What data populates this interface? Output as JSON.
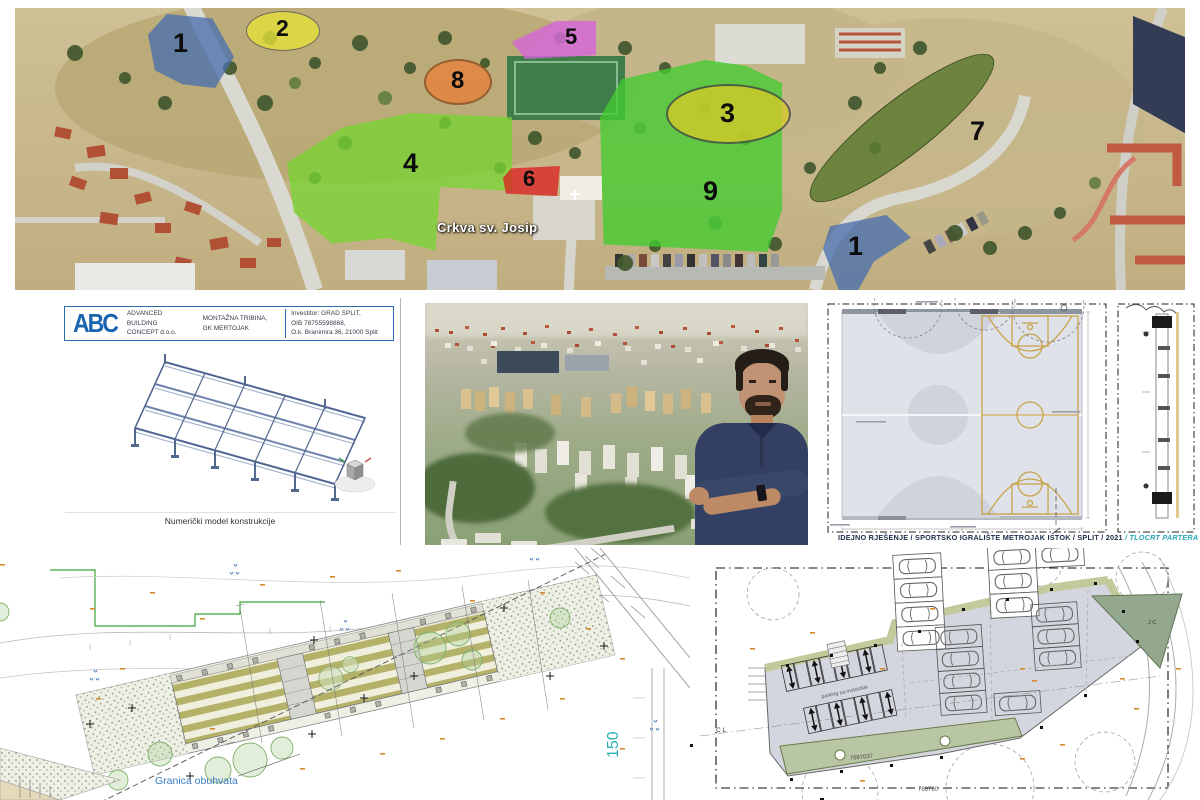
{
  "aerial": {
    "zones": [
      {
        "id": "1a",
        "label": "1",
        "color": "#4a6fae"
      },
      {
        "id": "2",
        "label": "2",
        "color": "#e6e33a"
      },
      {
        "id": "5",
        "label": "5",
        "color": "#d663dd"
      },
      {
        "id": "8",
        "label": "8",
        "color": "#e8823c"
      },
      {
        "id": "4",
        "label": "4",
        "color": "#79d433"
      },
      {
        "id": "6",
        "label": "6",
        "color": "#dd2222"
      },
      {
        "id": "3",
        "label": "3",
        "color": "#d6c929"
      },
      {
        "id": "9",
        "label": "9",
        "color": "#42cc30"
      },
      {
        "id": "7",
        "label": "7",
        "color": "#5d7c31"
      },
      {
        "id": "1b",
        "label": "1",
        "color": "#4a6fae"
      }
    ],
    "place_label": "Crkva sv. Josip"
  },
  "doc_panel": {
    "logo_text": "ABC",
    "company_line1": "ADVANCED",
    "company_line2": "BUILDING",
    "company_line3": "CONCEPT d.o.o.",
    "project_line1": "MONTAŽNA TRIBINA,",
    "project_line2": "GK MERTOJAK",
    "investor_line1": "Investitor:  GRAD SPLIT,",
    "investor_line2": "OIB 78755598868,",
    "investor_line3": "O.k. Branimira 36, 21000 Split",
    "model_caption": "Numerički model konstrukcije"
  },
  "courts_panel": {
    "caption_title": "IDEJNO RJEŠENJE / SPORTSKO IGRALIŠTE METROJAK ISTOK",
    "caption_mid": "  /  SPLIT /  2021  ",
    "caption_accent": "/  TLOCRT PARTERA /",
    "accent_color": "#2aa7b8"
  },
  "site_plan": {
    "boundary_label": "Granica obuhvata",
    "label_color": "#3a7abf",
    "scale_label": "150",
    "scale_color": "#2ab0b0"
  },
  "parking_plan": {
    "moto_label": "parking za motocikle",
    "parcel_label_1": "7697037",
    "parcel_label_2": "769780",
    "axis_left": "C L",
    "axis_right": "J C"
  }
}
